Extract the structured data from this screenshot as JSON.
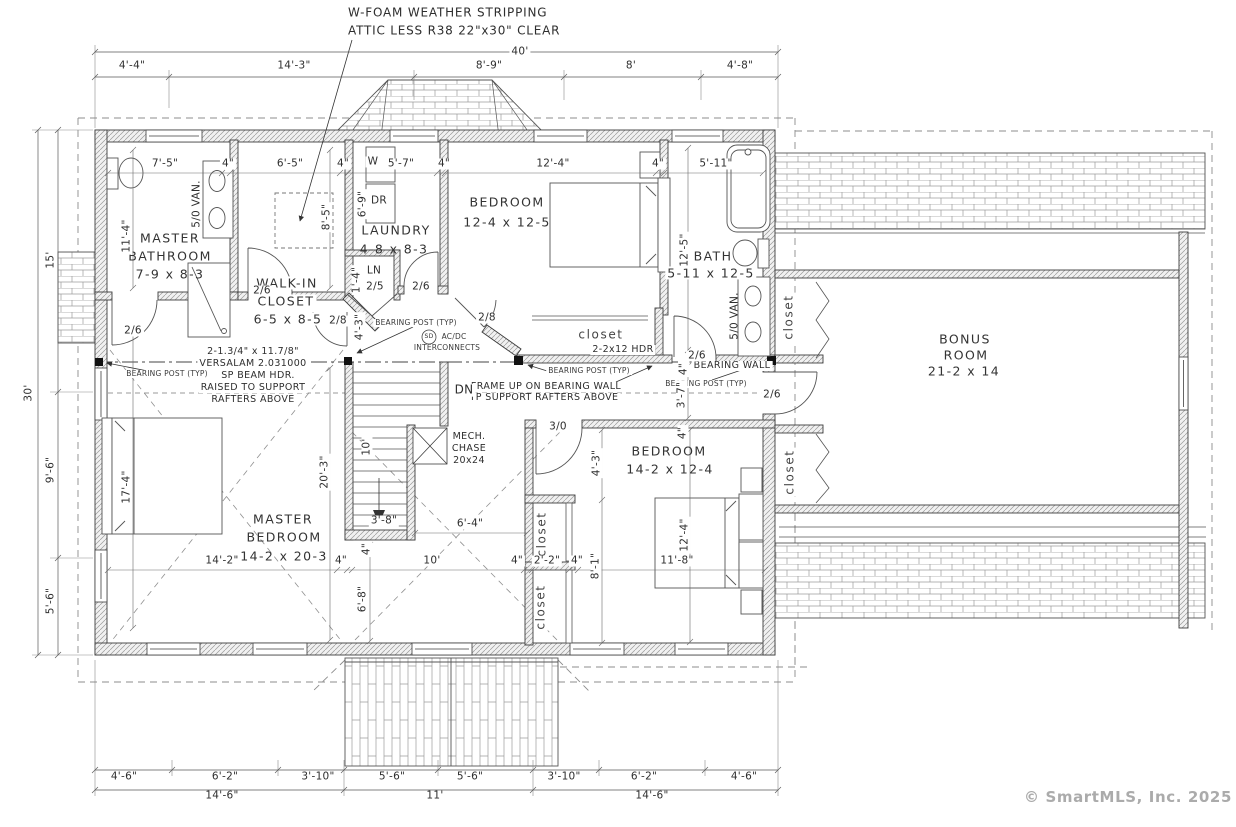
{
  "notes": {
    "weather1": "W-FOAM WEATHER STRIPPING",
    "weather2": "ATTIC LESS R38 22\"x30\" CLEAR",
    "beam1": "2-1.3/4\" x 11.7/8\"",
    "beam2": "VERSALAM 2.031000",
    "beam3": "SP BEAM HDR.",
    "beam4": "RAISED TO SUPPORT",
    "beam5": "RAFTERS ABOVE",
    "frame1": "FRAME  UP ON BEARING WALL",
    "frame2": "TP SUPPORT RAFTERS ABOVE",
    "bearing_post": "BEARING POST (TYP)",
    "bearing_wall": "BEARING WALL",
    "sd": "SD",
    "sd_line1": "AC/DC",
    "sd_line2": "INTERCONNECTS",
    "hdr": "2-2x12 HDR",
    "dn": "DN"
  },
  "rooms": {
    "master_bath": {
      "l1": "MASTER",
      "l2": "BATHROOM",
      "size": "7-9 x 8-3"
    },
    "walk_in": {
      "l1": "WALK-IN",
      "l2": "CLOSET",
      "size": "6-5 x 8-5"
    },
    "laundry": {
      "l1": "LAUNDRY",
      "size": "4-8 x 8-3",
      "washer": "W",
      "dryer": "DR",
      "linen": "LN"
    },
    "bedroom1": {
      "l1": "BEDROOM",
      "size": "12-4 x 12-5"
    },
    "bath": {
      "l1": "BATH",
      "size": "5-11 x 12-5"
    },
    "bonus": {
      "l1": "BONUS",
      "l2": "ROOM",
      "size": "21-2 x 14"
    },
    "master_bedroom": {
      "l1": "MASTER",
      "l2": "BEDROOM",
      "size": "14-2 x 20-3"
    },
    "bedroom2": {
      "l1": "BEDROOM",
      "size": "14-2 x 12-4"
    },
    "mech": {
      "l1": "MECH.",
      "l2": "CHASE",
      "l3": "20x24"
    },
    "closet": "closet",
    "vanity": "5/0 VAN."
  },
  "doors": {
    "d26": "2/6",
    "d28": "2/8",
    "d25": "2/5",
    "d30": "3/0"
  },
  "dims": {
    "top": {
      "overall": "40'",
      "s": [
        "4'-4\"",
        "14'-3\"",
        "8'-9\"",
        "8'",
        "4'-8\""
      ]
    },
    "left": {
      "overall": "30'",
      "s": [
        "15'",
        "9'-6\"",
        "5'-6\""
      ]
    },
    "bottom": {
      "s": [
        "4'-6\"",
        "6'-2\"",
        "3'-10\"",
        "5'-6\"",
        "5'-6\"",
        "3'-10\"",
        "6'-2\"",
        "4'-6\""
      ],
      "g": [
        "14'-6\"",
        "11'",
        "14'-6\""
      ]
    },
    "inner": {
      "w75": "7'-5\"",
      "w4": "4\"",
      "w65": "6'-5\"",
      "w57": "5'-7\"",
      "w124": "12'-4\"",
      "w511": "5'-11\"",
      "h114": "11'-4\"",
      "h85": "8'-5\"",
      "h69": "6'-9\"",
      "h14": "1'-4\"",
      "h125": "12'-5\"",
      "h43": "4'-3\"",
      "h37": "3'-7\"",
      "h203": "20'-3\"",
      "s10": "10'",
      "s38": "3'-8\"",
      "w64": "6'-4\"",
      "w142": "14'-2\"",
      "w22": "2'-2\"",
      "h81": "8'-1\"",
      "w118": "11'-8\"",
      "h68": "6'-8\"",
      "h174": "17'-4\""
    }
  },
  "footer": {
    "copyright": "© SmartMLS, Inc.  2025"
  }
}
